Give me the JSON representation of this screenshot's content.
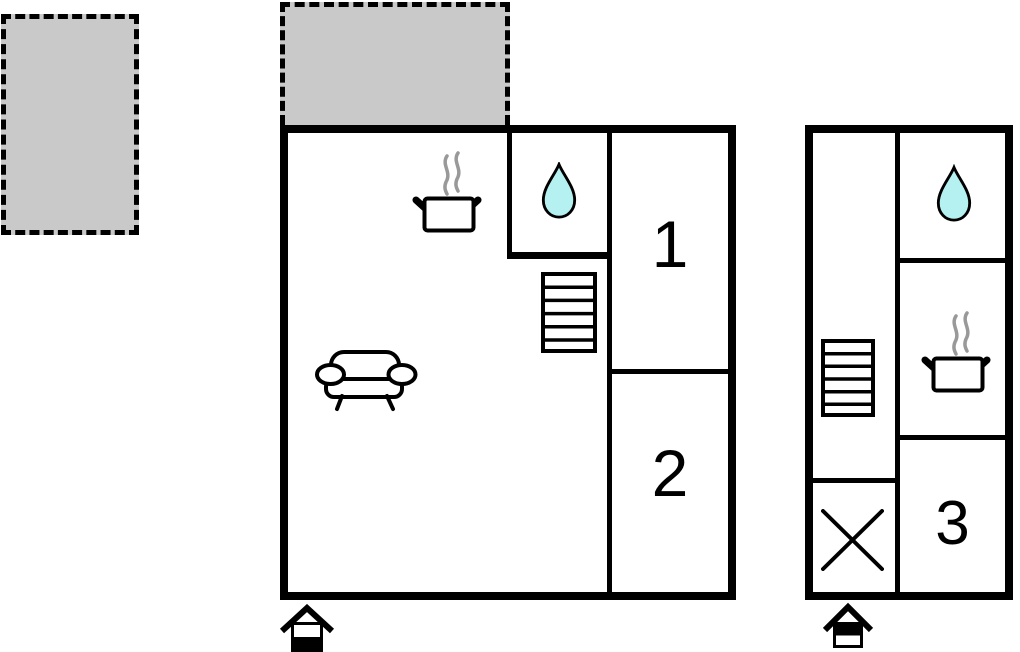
{
  "colors": {
    "wall": "#000000",
    "terrace_fill": "#c9c9c9",
    "terrace_border": "#000000",
    "water_drop_fill": "#b5f1f1",
    "steam": "#999999",
    "label_color": "#000000",
    "background": "#ffffff"
  },
  "plan": {
    "terraces": [
      {
        "name": "terrace-top-left",
        "style": "dashed-outline-gray"
      },
      {
        "name": "terrace-above-main-building",
        "style": "dashed-outline-gray"
      }
    ],
    "main_building": {
      "living_area_icons": [
        "stove-pot-icon",
        "sofa-icon",
        "stairs-icon"
      ],
      "bathroom_icons": [
        "water-drop-icon"
      ],
      "rooms": {
        "room1": {
          "label": "1"
        },
        "room2": {
          "label": "2"
        }
      },
      "entrance": {
        "icon": "entrance-house-icon",
        "variant": "lower-half-filled"
      }
    },
    "annex_building": {
      "icons": [
        "water-drop-icon",
        "stove-pot-icon",
        "stairs-icon",
        "crossed-area-icon"
      ],
      "rooms": {
        "room3": {
          "label": "3"
        }
      },
      "entrance": {
        "icon": "entrance-house-icon",
        "variant": "upper-half-filled"
      }
    }
  }
}
